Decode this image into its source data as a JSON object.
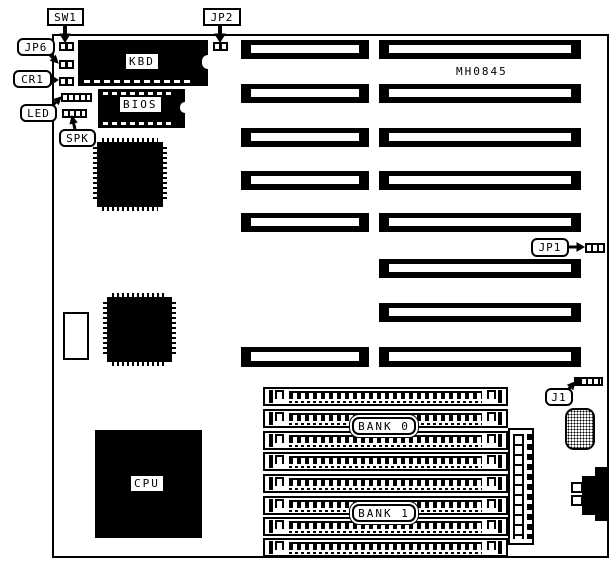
{
  "diagram": {
    "type": "motherboard-layout",
    "model_text": "MH0845",
    "ink_color": "#000000",
    "paper_color": "#ffffff"
  },
  "chips": {
    "kbd": "KBD",
    "bios": "BIOS",
    "cpu": "CPU"
  },
  "callouts": {
    "sw1": "SW1",
    "jp2": "JP2",
    "jp6": "JP6",
    "cr1": "CR1",
    "led": "LED",
    "spk": "SPK",
    "jp1": "JP1",
    "j1": "J1"
  },
  "memory": {
    "bank0_label": "BANK 0",
    "bank1_label": "BANK 1",
    "simm_slots_per_bank": 4
  },
  "expansion": {
    "left_column_slots": 6,
    "right_column_slots": 8
  }
}
